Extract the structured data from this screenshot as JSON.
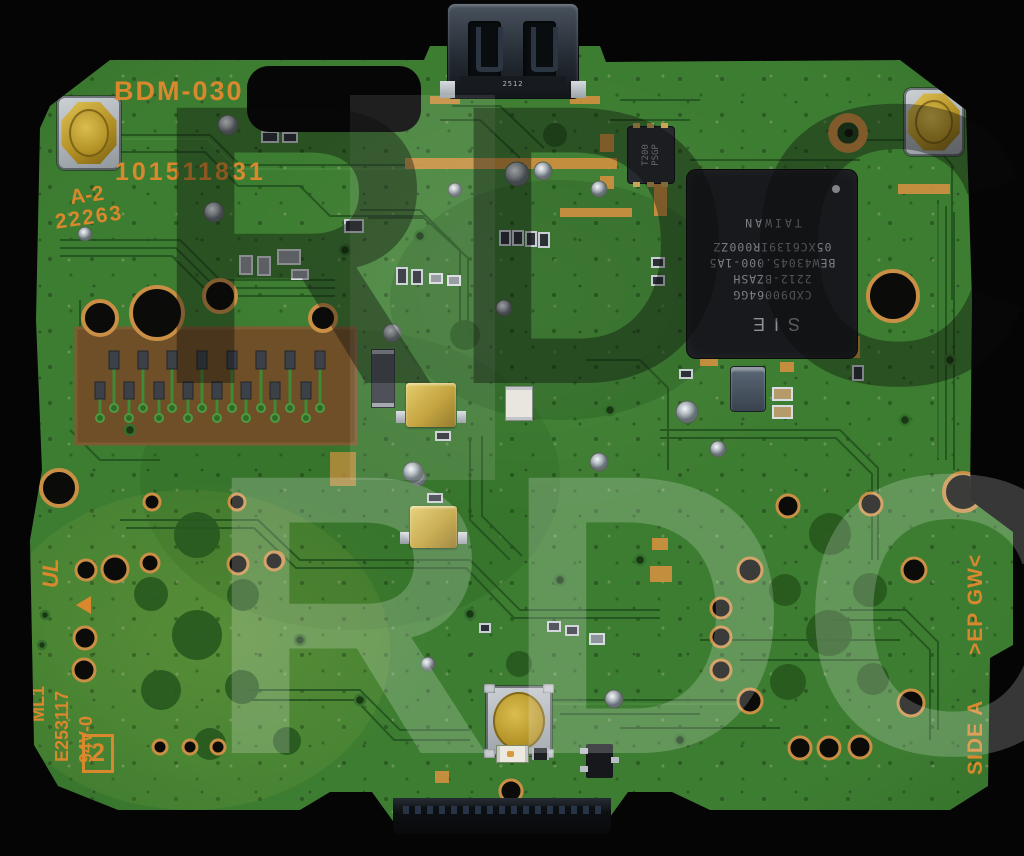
{
  "watermark": {
    "text": "RDC"
  },
  "silkscreen": {
    "model": "BDM-030",
    "serial": "101511831",
    "revision": "A-2",
    "date_code": "22263",
    "ul_mark": "UL",
    "flammability_line1": "ML1",
    "flammability_line2": "E253117",
    "flammability_line3": "94V-0",
    "layer_marker": "2",
    "panel_marking": ">EP GW<",
    "side_label": "SIDE A"
  },
  "main_ic": {
    "brand": "SIE",
    "part_number": "CXD90064GG",
    "lot_code": "2212-BZASH",
    "code_line1": "BEW43045.000-1A5",
    "code_line2": "05XC6139IR000ZZ",
    "country": "TAIWAN"
  },
  "small_ic": {
    "line1": "T200",
    "line2": "PSGP"
  },
  "usb_connector": {
    "marking": "2512"
  },
  "colors": {
    "board_green": "#3d7d31",
    "silkscreen_orange": "#d9882e",
    "copper": "#cf9040",
    "chip_black": "#17191c"
  }
}
